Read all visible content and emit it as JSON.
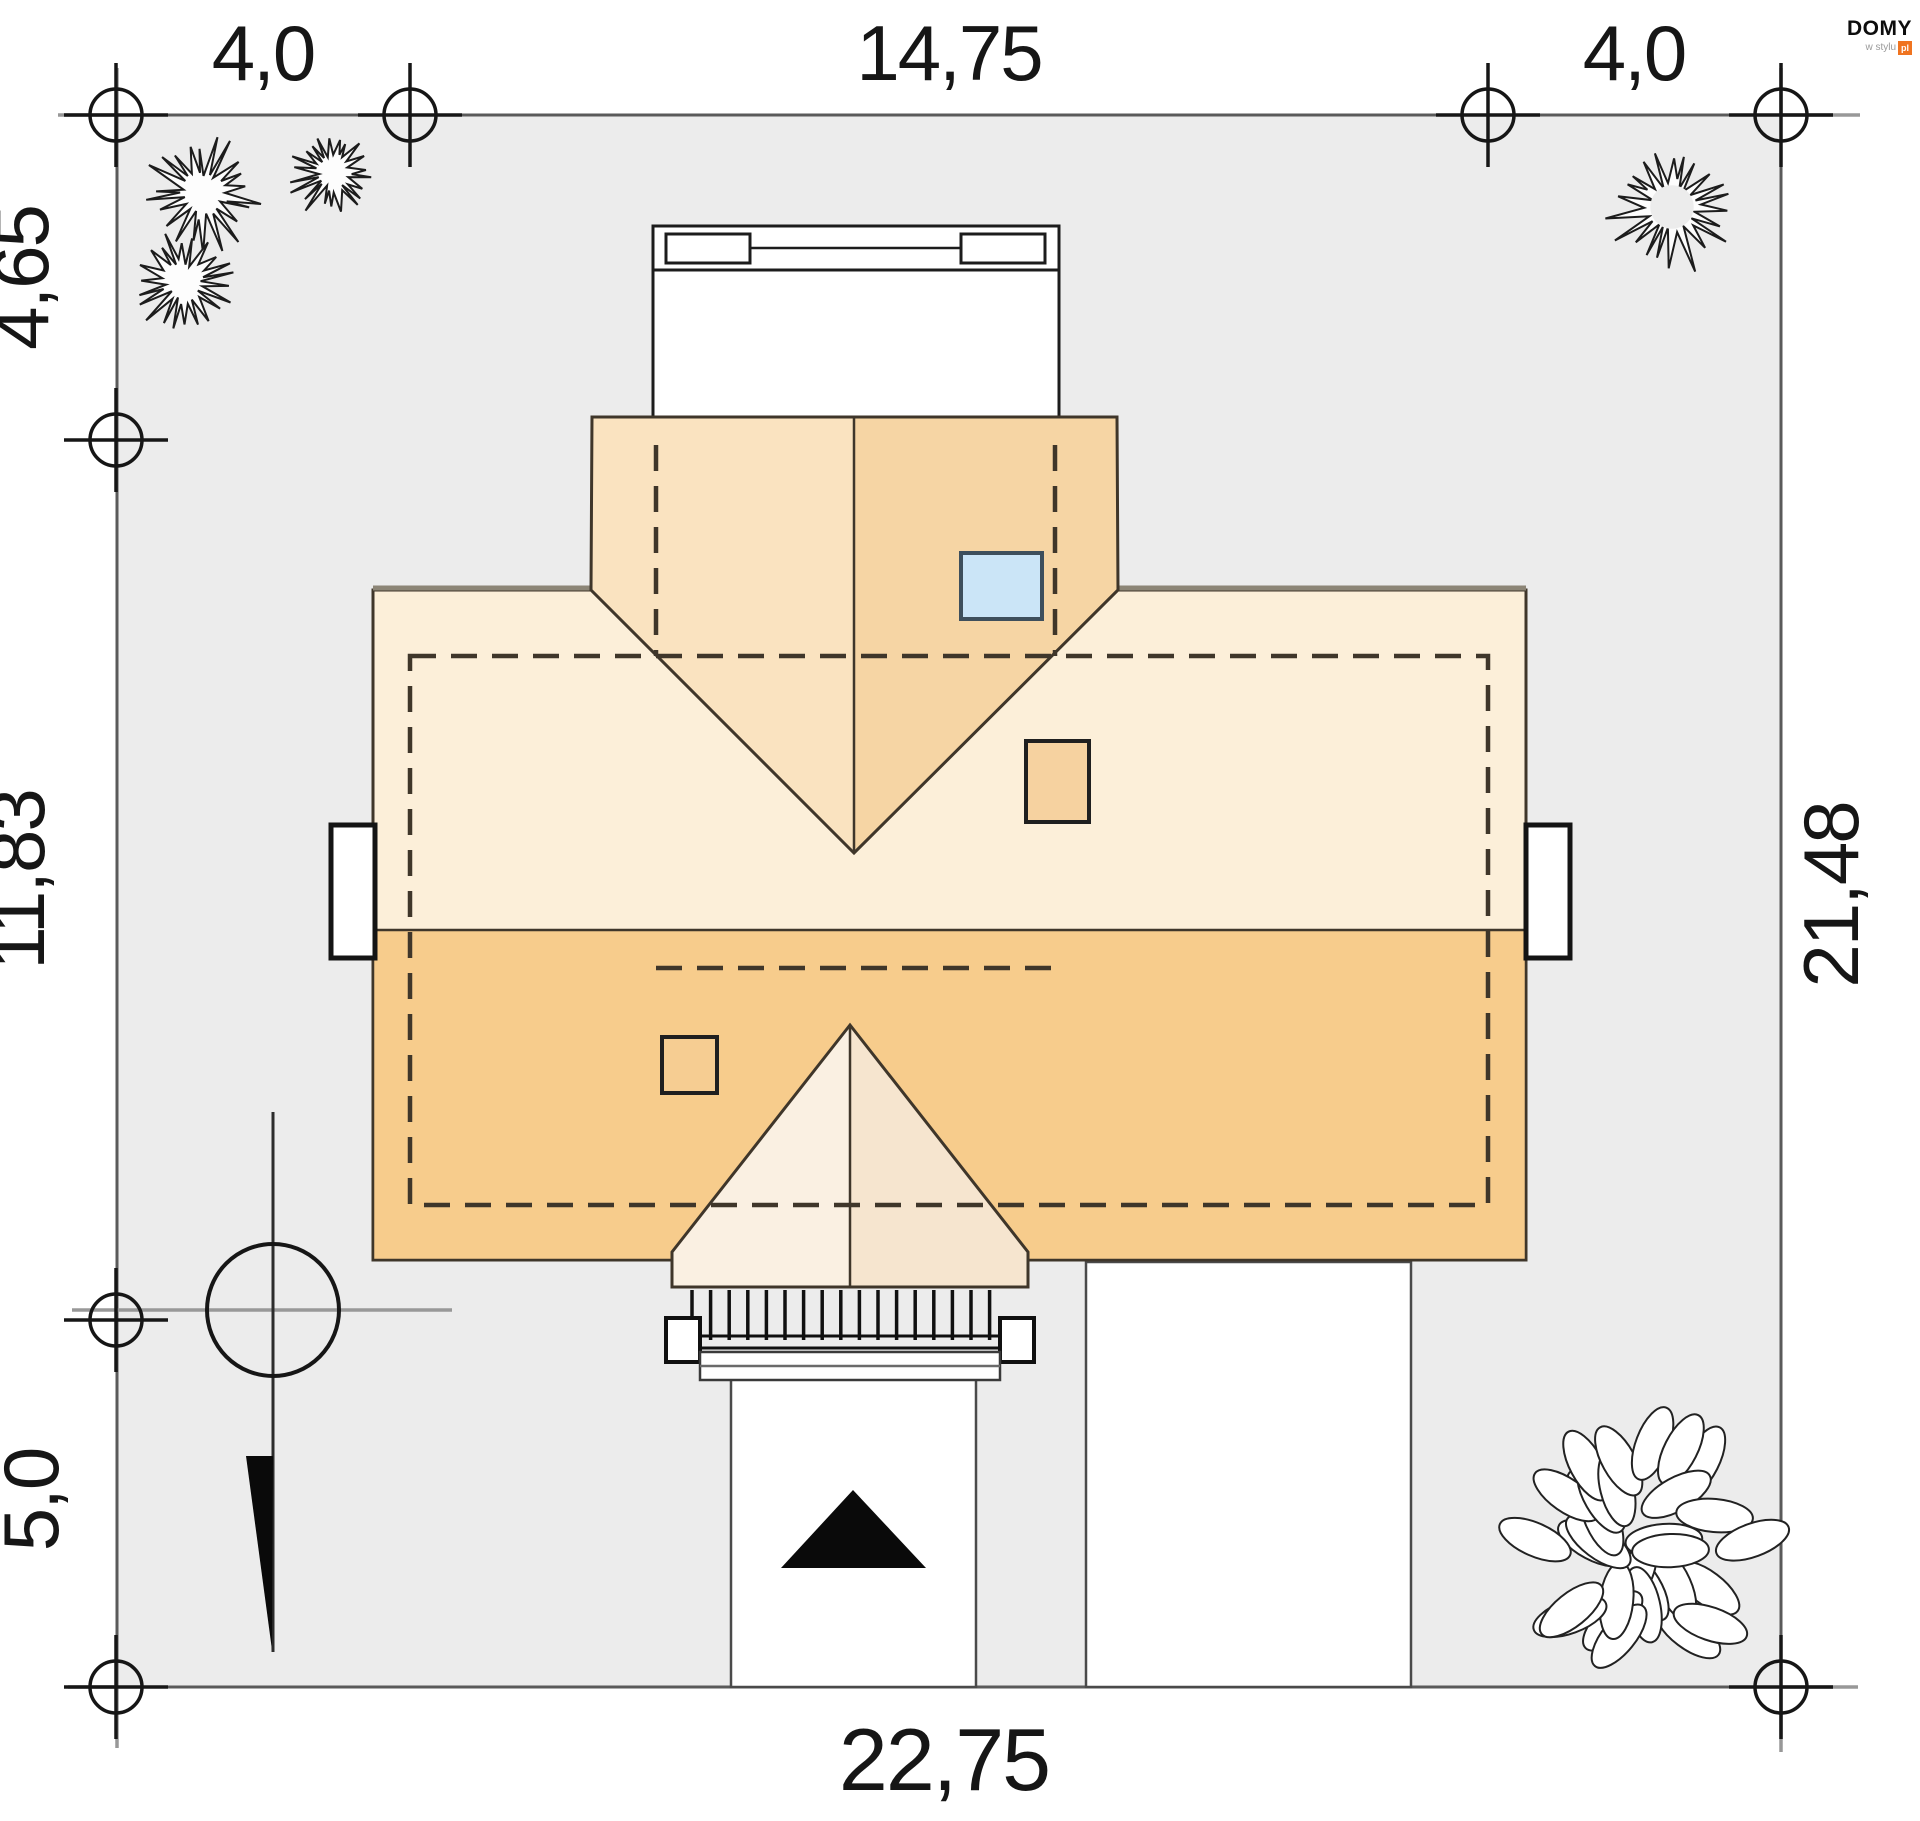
{
  "plan": {
    "type": "house-site-plan",
    "plot_dimensions": {
      "top_left_offset": "4,0",
      "top_house_width": "14,75",
      "top_right_offset": "4,0",
      "left_upper_offset": "4,65",
      "left_house_depth": "11,83",
      "left_lower_offset": "5,0",
      "right_side_total": "21,48",
      "bottom_total": "22,75"
    }
  },
  "dimensions": {
    "top_left": "4,0",
    "top_center": "14,75",
    "top_right": "4,0",
    "left_upper": "4,65",
    "left_middle": "11,83",
    "left_lower": "5,0",
    "right_side": "21,48",
    "bottom": "22,75"
  },
  "logo": {
    "brand": "DOMY",
    "tagline": "w stylu",
    "suffix": "pl"
  },
  "colors": {
    "plot_fill": "#ececec",
    "plot_stroke": "#5a5a5a",
    "dim_line": "#989898",
    "marker_stroke": "#161616",
    "roof_light": "#fcefd9",
    "roof_dark": "#f7cc8c",
    "dormer_left": "#fae3c0",
    "dormer_right": "#f6d5a4",
    "porch_left": "#faf0e2",
    "porch_right": "#f6e5cf",
    "skylight_fill": "#cbe5f7",
    "skylight_stroke": "#3e4f5c",
    "chimney_fill": "#f6d2a0",
    "outline": "#3f362a",
    "logo_accent": "#f07420"
  }
}
